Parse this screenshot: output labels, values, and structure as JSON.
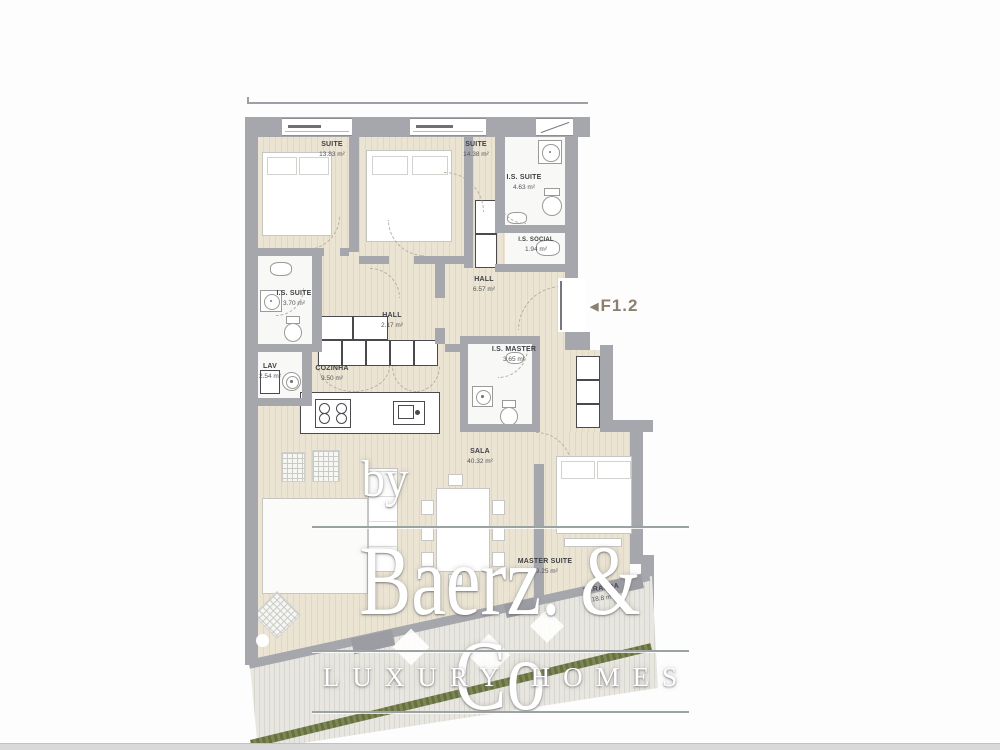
{
  "unit": {
    "marker": "◀",
    "label": "F1.2"
  },
  "rooms": [
    {
      "id": "suite1",
      "name": "SUITE",
      "area": "13.83 m²"
    },
    {
      "id": "suite2",
      "name": "SUITE",
      "area": "14.38 m²"
    },
    {
      "id": "is_suite_top",
      "name": "I.S. SUITE",
      "area": "4.63 m²"
    },
    {
      "id": "is_social",
      "name": "I.S. SOCIAL",
      "area": "1.94 m²"
    },
    {
      "id": "hall_main",
      "name": "HALL",
      "area": "6.57 m²"
    },
    {
      "id": "is_suite_left",
      "name": "I.S. SUITE",
      "area": "3.70 m²"
    },
    {
      "id": "hall_small",
      "name": "HALL",
      "area": "2.17 m²"
    },
    {
      "id": "lav",
      "name": "LAV",
      "area": "2.54 m²"
    },
    {
      "id": "cozinha",
      "name": "COZINHA",
      "area": "9.50 m²"
    },
    {
      "id": "is_master",
      "name": "I.S. MASTER",
      "area": "3.65 m²"
    },
    {
      "id": "sala",
      "name": "SALA",
      "area": "40.32 m²"
    },
    {
      "id": "master_suite",
      "name": "MASTER SUITE",
      "area": "19.25 m²"
    },
    {
      "id": "varanda",
      "name": "VARANDA",
      "area": "18.8 m²"
    }
  ],
  "watermark": {
    "prefix": "by",
    "brand": "Baerz. & Co",
    "tagline": "LUXURY HOMES"
  },
  "colors": {
    "wall": "#a6a6ad",
    "wood_floor": "#e9e2d1",
    "deck": "#e2dfd7",
    "hedge": "#76804e",
    "label_text": "#3e3f44",
    "unit_label": "#8b7f70",
    "watermark_line": "#9aa2a2"
  }
}
